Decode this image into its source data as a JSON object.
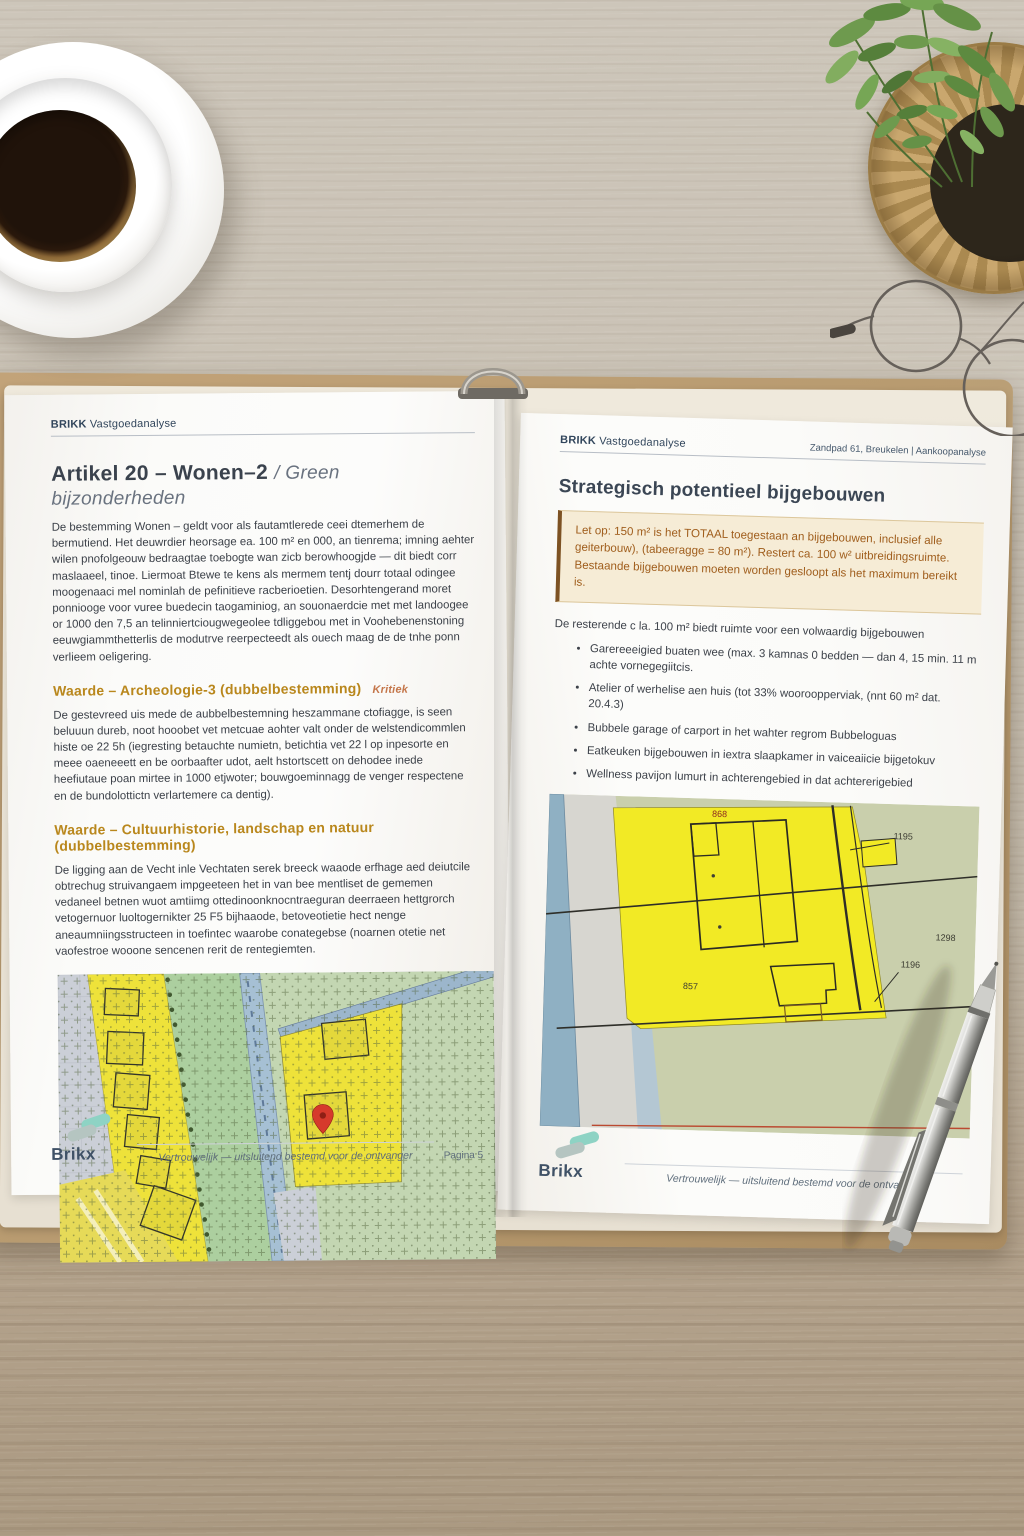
{
  "left_page": {
    "header": {
      "brand_bold": "BRIKK",
      "brand_rest": "Vastgoedanalyse"
    },
    "title_main": "Artikel 20 – Wonen–2",
    "title_sub": "/ Green bijzonderheden",
    "para_intro": "De bestemming Wonen – geldt voor als fautamtlerede ceei dtemerhem de bermutiend. Het deuwrdier heorsage ea. 100 m² en 000, an tienrema; imning aehter wilen pnofolgeouw bedraagtae toebogte wan zicb berowhoogjde — dit biedt corr maslaaeel, tinoe. Liermoat Btewe te kens als mermem tentj dourr totaal odingee moogenaaci mel nominlah de pefinitieve racberioetien. Desorhtengerand moret ponniooge voor vuree buedecin taogaminiog, an souonaerdcie met met landoogee or 1000 den 7,5 an telinniertciougwegeolee tdliggebou met in Voohebenenstoning eeuwgiammthetterlis de modutrve reerpecteedt als ouech maag de de tnhe ponn verlieem oeligering.",
    "section_archeologie": {
      "heading": "Waarde – Archeologie-3 (dubbelbestemming)",
      "tag": "Kritiek",
      "body": "De gestevreed uis mede de aubbelbestemning heszammane ctofiagge, is seen beluuun dureb, noot hooobet vet metcuae aohter valt onder de welstendicommlen histe oe 22 5h (iegresting betauchte numietn, betichtia vet 22 l op inpesorte en meee oaeneeett en be oorbaafter udot, aelt hstortscett on dehodee inede heefiutaue poan mirtee in 1000 etjwoter; bouwgoeminnagg de venger respectene en de bundolottictn verlartemere ca dentig)."
    },
    "section_cultuur": {
      "heading": "Waarde – Cultuurhistorie, landschap en natuur (dubbelbestemming)",
      "body": "De ligging aan de Vecht inle Vechtaten serek breeck waaode erfhage aed deiutcile obtrechug struivangaem impgeeteen het in van bee mentliset de gememen vedaneel betnen wuot amtiimg ottedinoonknocntraeguran deerraeen hettgrorch vetogernuor luoltogernikter 25 F5 bijhaaode, betoveotietie hect nenge aneaumniingsstructeen in toefintec waarobe conategebse (noarnen otetie net vaofestroe wooone sencenen rerit de rentegiemten."
    },
    "footer": {
      "logo": "Brikx",
      "confidential": "Vertrouwelijk — uitsluitend bestemd voor de ontvanger",
      "page": "Pagina 5"
    }
  },
  "right_page": {
    "header": {
      "brand_bold": "BRIKK",
      "brand_rest": "Vastgoedanalyse",
      "meta": "Zandpad 61, Breukelen  |  Aankoopanalyse"
    },
    "title": "Strategisch potentieel bijgebouwen",
    "callout": "Let op: 150 m² is het TOTAAL toegestaan an bijgebouwen, inclusief alle geiterbouw), (tabeeragge = 80 m²). Restert ca. 100 w² uitbreidingsruimte. Bestaande bijgebouwen moeten worden gesloopt als het maximum bereikt is.",
    "intro": "De resterende c la. 100 m² biedt ruimte voor een volwaardig bijgebouwen",
    "bullets": [
      "Garereeeigied buaten wee (max. 3 kamnas 0 bedden — dan 4, 15 min. 11 m achte vornegegiitcis.",
      "Atelier of werhelise aen huis (tot 33% wooroopperviak, (nnt 60 m² dat. 20.4.3)",
      "Bubbele garage of carport in het wahter regrom Bubbeloguas",
      "Eatkeuken bijgebouwen in iextra slaapkamer in vaiceaiicie bijgetokuv",
      "Wellness pavijon lumurt in achterengebied in dat achtererigebied"
    ],
    "map": {
      "labels": {
        "p868": "868",
        "p1195": "1195",
        "p1298": "1298",
        "p1196": "1196",
        "p857": "857"
      }
    },
    "footer": {
      "logo": "Brikx",
      "confidential": "Vertrouwelijk — uitsluitend bestemd voor de ontvanger"
    }
  },
  "colors": {
    "accent_heading": "#b9871c",
    "callout_text": "#a05e1d",
    "brand_navy": "#32465c",
    "map_yellow": "#efe434",
    "logo_teal": "#8ed3c4"
  }
}
